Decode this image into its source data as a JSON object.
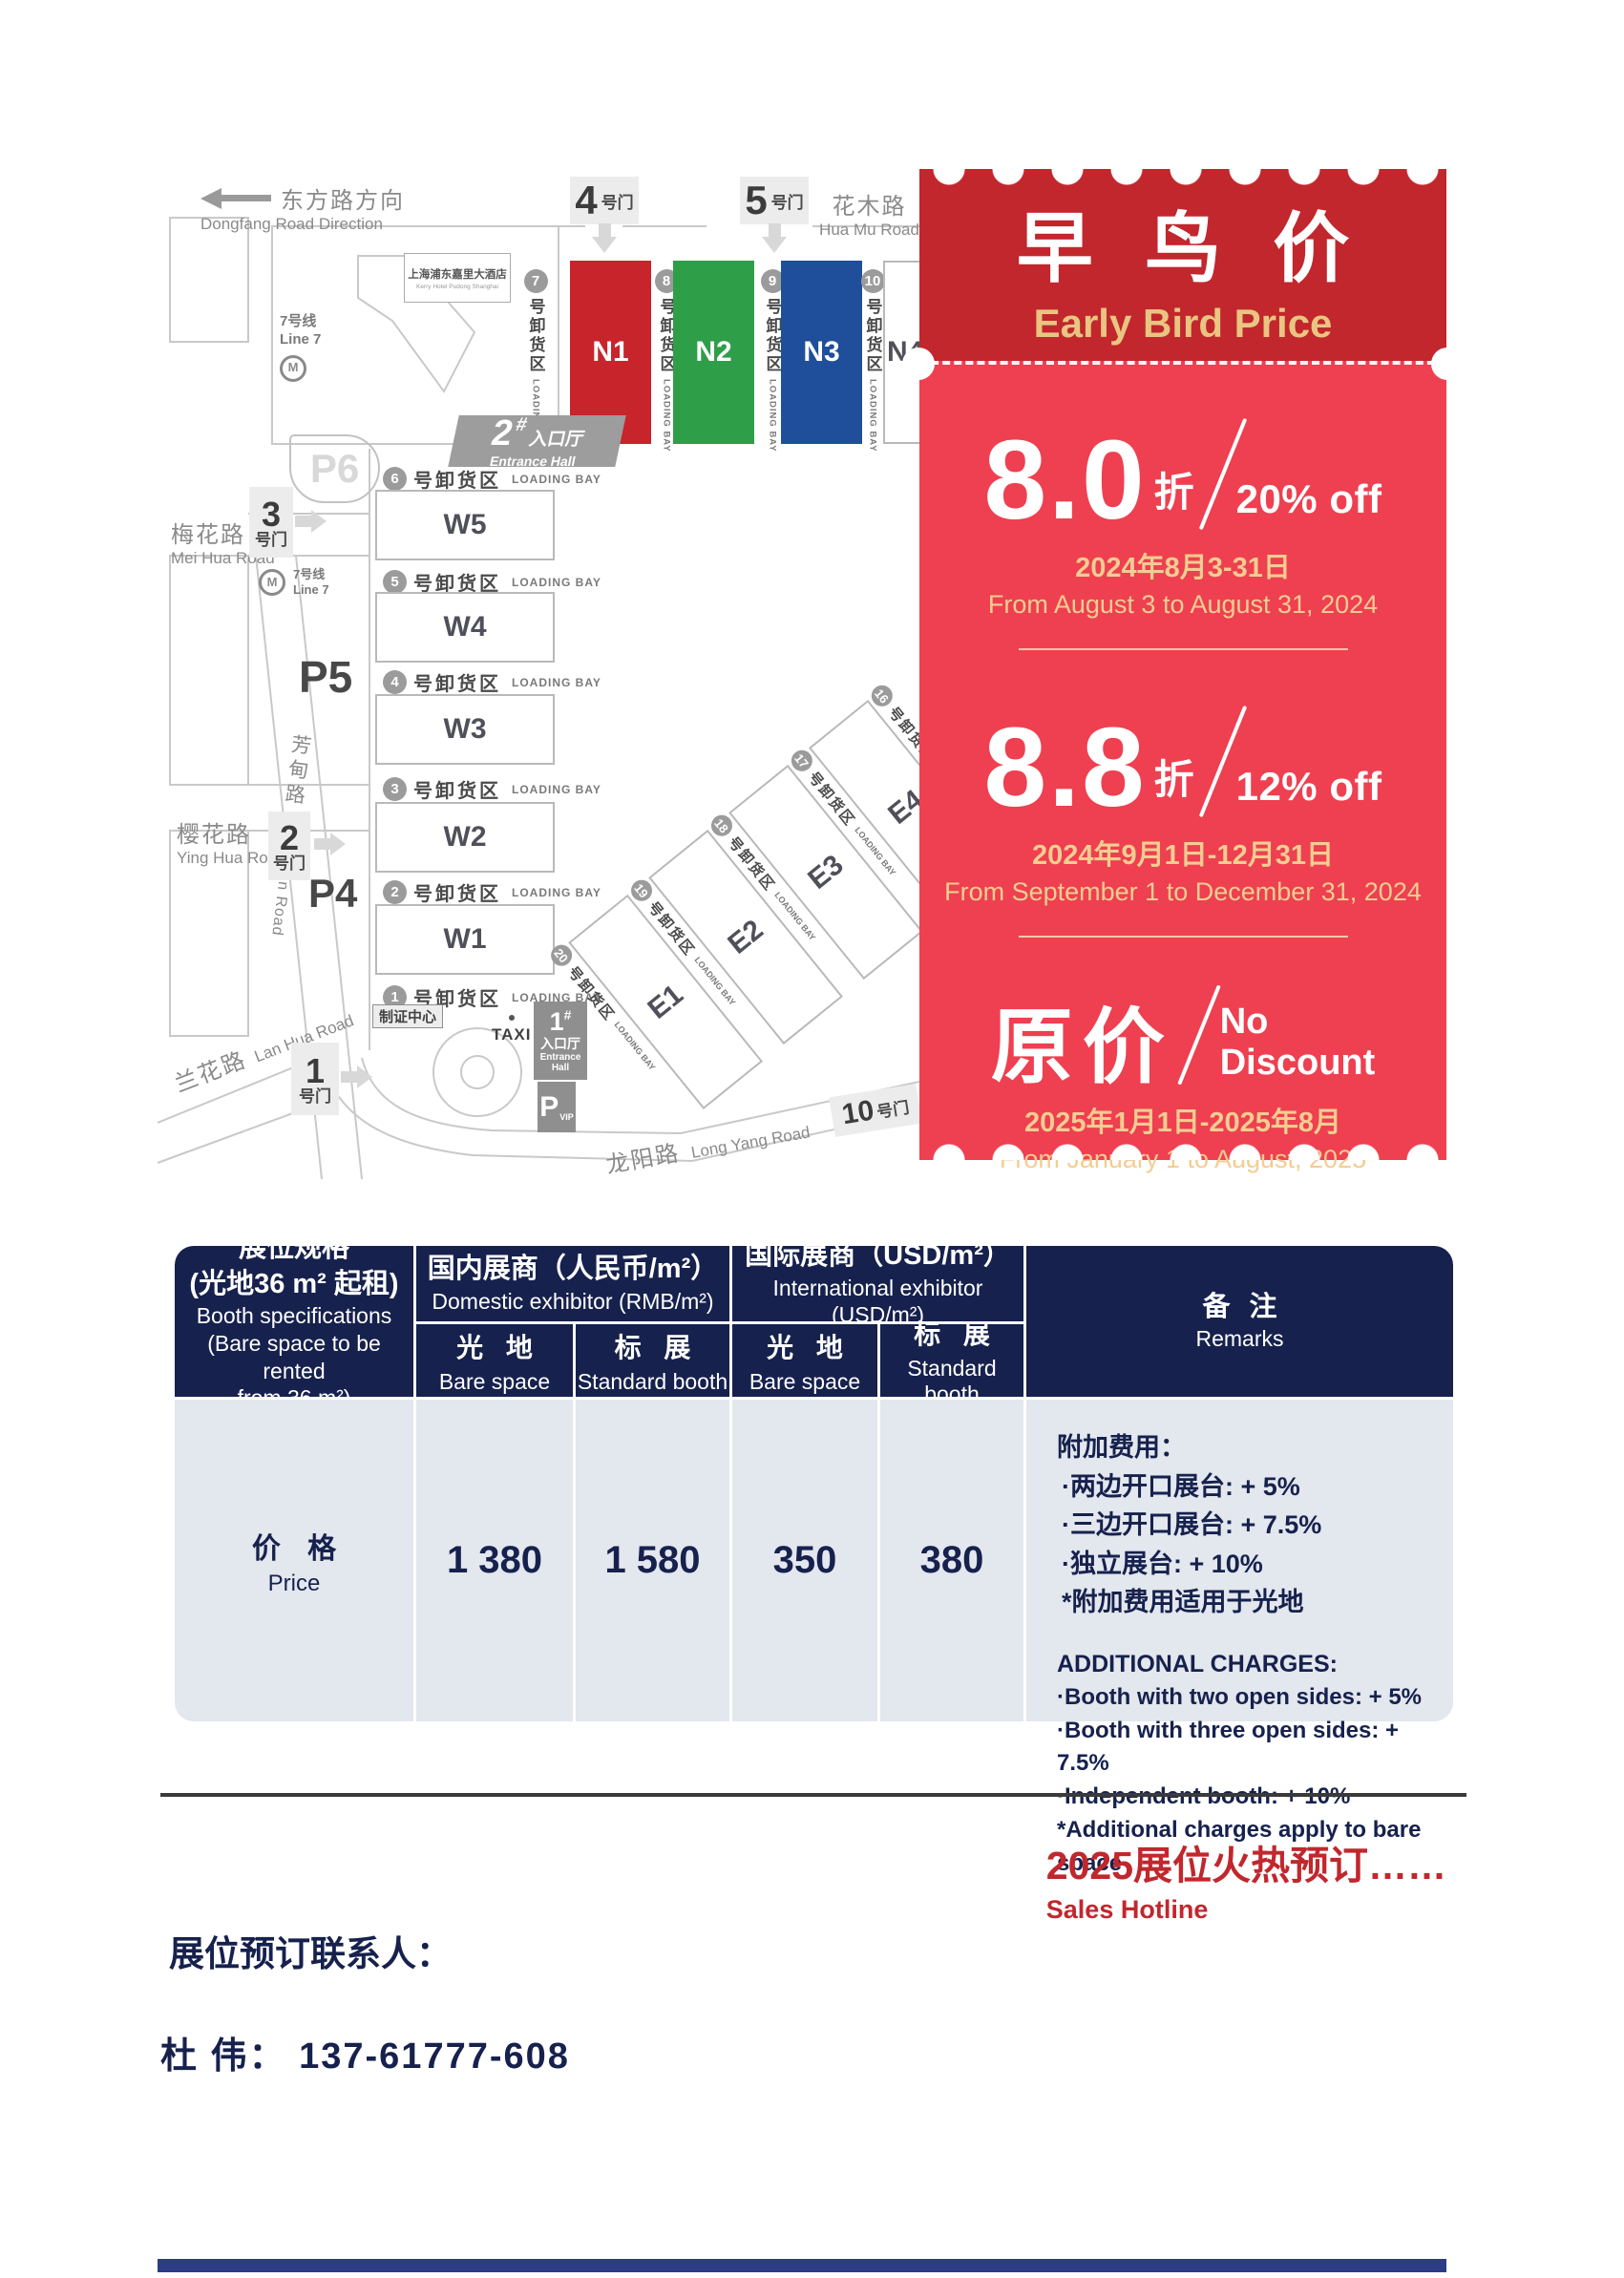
{
  "colors": {
    "coupon_header": "#c1272d",
    "coupon_body": "#ee4050",
    "gold_text": "#e9c582",
    "table_navy": "#16214d",
    "table_light": "#e3e7ee",
    "hall_n1_red": "#c8242c",
    "hall_n2_green": "#2f9e49",
    "hall_n3_blue": "#1f4e9b",
    "accent_red": "#c1272d"
  },
  "map": {
    "dongfang_zh": "东方路方向",
    "dongfang_en": "Dongfang Road Direction",
    "huamu_zh": "花木路",
    "huamu_en": "Hua Mu Road",
    "meihua_zh": "梅花路",
    "meihua_en": "Mei Hua Road",
    "fangdian_zh": "芳甸路",
    "fangdian_en": "Fang Dian Road",
    "yinghua_zh": "樱花路",
    "yinghua_en": "Ying Hua Road",
    "lanhua_zh": "兰花路",
    "lanhua_en": "Lan Hua Road",
    "longyang_zh": "龙阳路",
    "longyang_en": "Long Yang Road",
    "hotel_zh": "上海浦东嘉里大酒店",
    "hotel_en": "Kerry Hotel Pudong Shanghai",
    "metro_zh": "7号线",
    "metro_en": "Line 7",
    "metro_m": "M",
    "gate_suffix": "号门",
    "gates": {
      "g1": "1",
      "g2": "2",
      "g3": "3",
      "g4": "4",
      "g5": "5",
      "g10": "10"
    },
    "parking": {
      "p4": "P4",
      "p5": "P5",
      "p6": "P6"
    },
    "pvip": "P",
    "pvip_sub": "VIP",
    "entrance2_num": "2",
    "entrance1_num": "1",
    "entrance_hash": "#",
    "entrance_zh": "入口厅",
    "entrance_en": "Entrance Hall",
    "badge_center": "制证中心",
    "taxi": "TAXI",
    "bay_zh": "号卸货区",
    "bay_en": "LOADING BAY",
    "north_halls": [
      "N1",
      "N2",
      "N3",
      "N4"
    ],
    "north_bays": [
      "7",
      "8",
      "9",
      "10"
    ],
    "west_halls": [
      "W5",
      "W4",
      "W3",
      "W2",
      "W1"
    ],
    "west_bays": [
      "6",
      "5",
      "4",
      "3",
      "2",
      "1"
    ],
    "east_halls": [
      "E1",
      "E2",
      "E3",
      "E4"
    ],
    "east_bays": [
      "20",
      "19",
      "18",
      "17",
      "16"
    ]
  },
  "coupon": {
    "title_zh": "早 鸟 价",
    "title_en": "Early Bird Price",
    "tier1_big": "8.0",
    "tier1_zhe": "折",
    "tier1_off": "20% off",
    "tier1_date_zh": "2024年8月3-31日",
    "tier1_date_en": "From August 3 to August 31, 2024",
    "tier2_big": "8.8",
    "tier2_zhe": "折",
    "tier2_off": "12% off",
    "tier2_date_zh": "2024年9月1日-12月31日",
    "tier2_date_en": "From September 1 to December 31, 2024",
    "tier3_big": "原价",
    "tier3_off1": "No",
    "tier3_off2": "Discount",
    "tier3_date_zh": "2025年1月1日-2025年8月",
    "tier3_date_en": "From January 1 to August, 2025"
  },
  "table": {
    "spec_zh1": "展位规格",
    "spec_zh2": "(光地36 m² 起租)",
    "spec_en1": "Booth specifications",
    "spec_en2": "(Bare space to be rented",
    "spec_en3": "from 36 m²)",
    "domestic_zh": "国内展商（人民币/m²）",
    "domestic_en": "Domestic exhibitor (RMB/m²)",
    "intl_zh": "国际展商（USD/m²）",
    "intl_en": "International exhibitor (USD/m²)",
    "bare_zh": "光 地",
    "bare_en": "Bare space",
    "std_zh": "标 展",
    "std_en": "Standard booth",
    "remarks_zh": "备 注",
    "remarks_en": "Remarks",
    "price_zh": "价 格",
    "price_en": "Price",
    "values": [
      "1 380",
      "1 580",
      "350",
      "380"
    ],
    "remarks_lines_zh": [
      "附加费用：",
      "·两边开口展台: + 5%",
      "·三边开口展台: + 7.5%",
      "·独立展台: + 10%",
      "*附加费用适用于光地"
    ],
    "remarks_lines_en": [
      "ADDITIONAL CHARGES:",
      "·Booth with two open sides: + 5%",
      "·Booth with three open sides: + 7.5%",
      "·Independent booth: + 10%",
      "*Additional charges apply to bare space"
    ]
  },
  "footer": {
    "hotline_zh": "2025展位火热预订……",
    "hotline_en": "Sales Hotline",
    "contact_label": "展位预订联系人：",
    "contact_name": "杜 伟： 137-61777-608"
  }
}
